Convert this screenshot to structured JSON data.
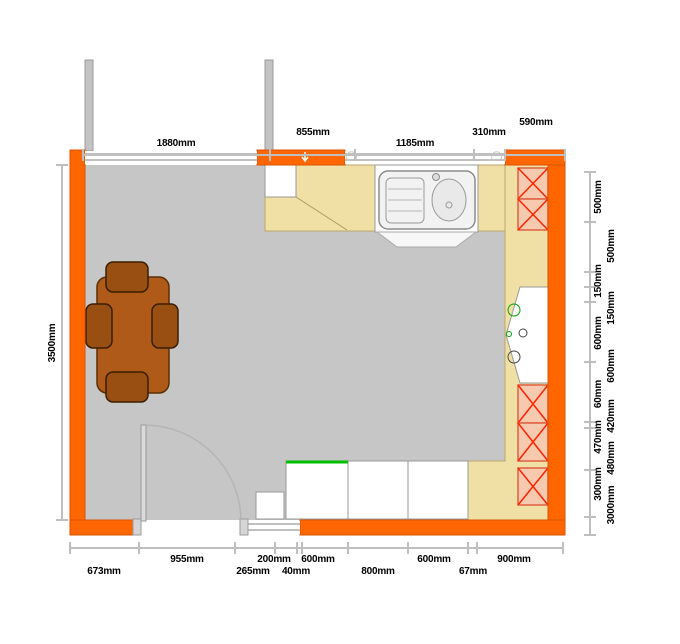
{
  "colors": {
    "wall": "#FF6600",
    "wall_outline": "#D95300",
    "floor": "#C6C6C6",
    "counter": "#F0E0A5",
    "counter_outline": "#B9A96B",
    "unit": "#FFFFFF",
    "unit_outline": "#999999",
    "wall_unit_fill": "#F7C9AE",
    "wall_unit_cross": "#FF2400",
    "table": "#B05A1A",
    "table_outline": "#5C2E05",
    "chair": "#9A4F12",
    "dim_line": "#BFBFBF",
    "dim_text": "#000000",
    "accent_green": "#00BE00",
    "window_frame": "#ABABAB",
    "adjacent_wall": "#C3C3C3"
  },
  "dimensions": {
    "top": [
      "1880mm",
      "855mm",
      "1185mm",
      "310mm",
      "590mm"
    ],
    "bottom_row1": [
      "955mm",
      "200mm",
      "600mm",
      "600mm",
      "900mm"
    ],
    "bottom_row2": [
      "673mm",
      "265mm",
      "40mm",
      "800mm",
      "67mm"
    ],
    "left": [
      "3500mm"
    ],
    "right": [
      "500mm",
      "500mm",
      "150mm",
      "150mm",
      "600mm",
      "600mm",
      "60mm",
      "420mm",
      "470mm",
      "480mm",
      "300mm",
      "3000mm"
    ]
  }
}
